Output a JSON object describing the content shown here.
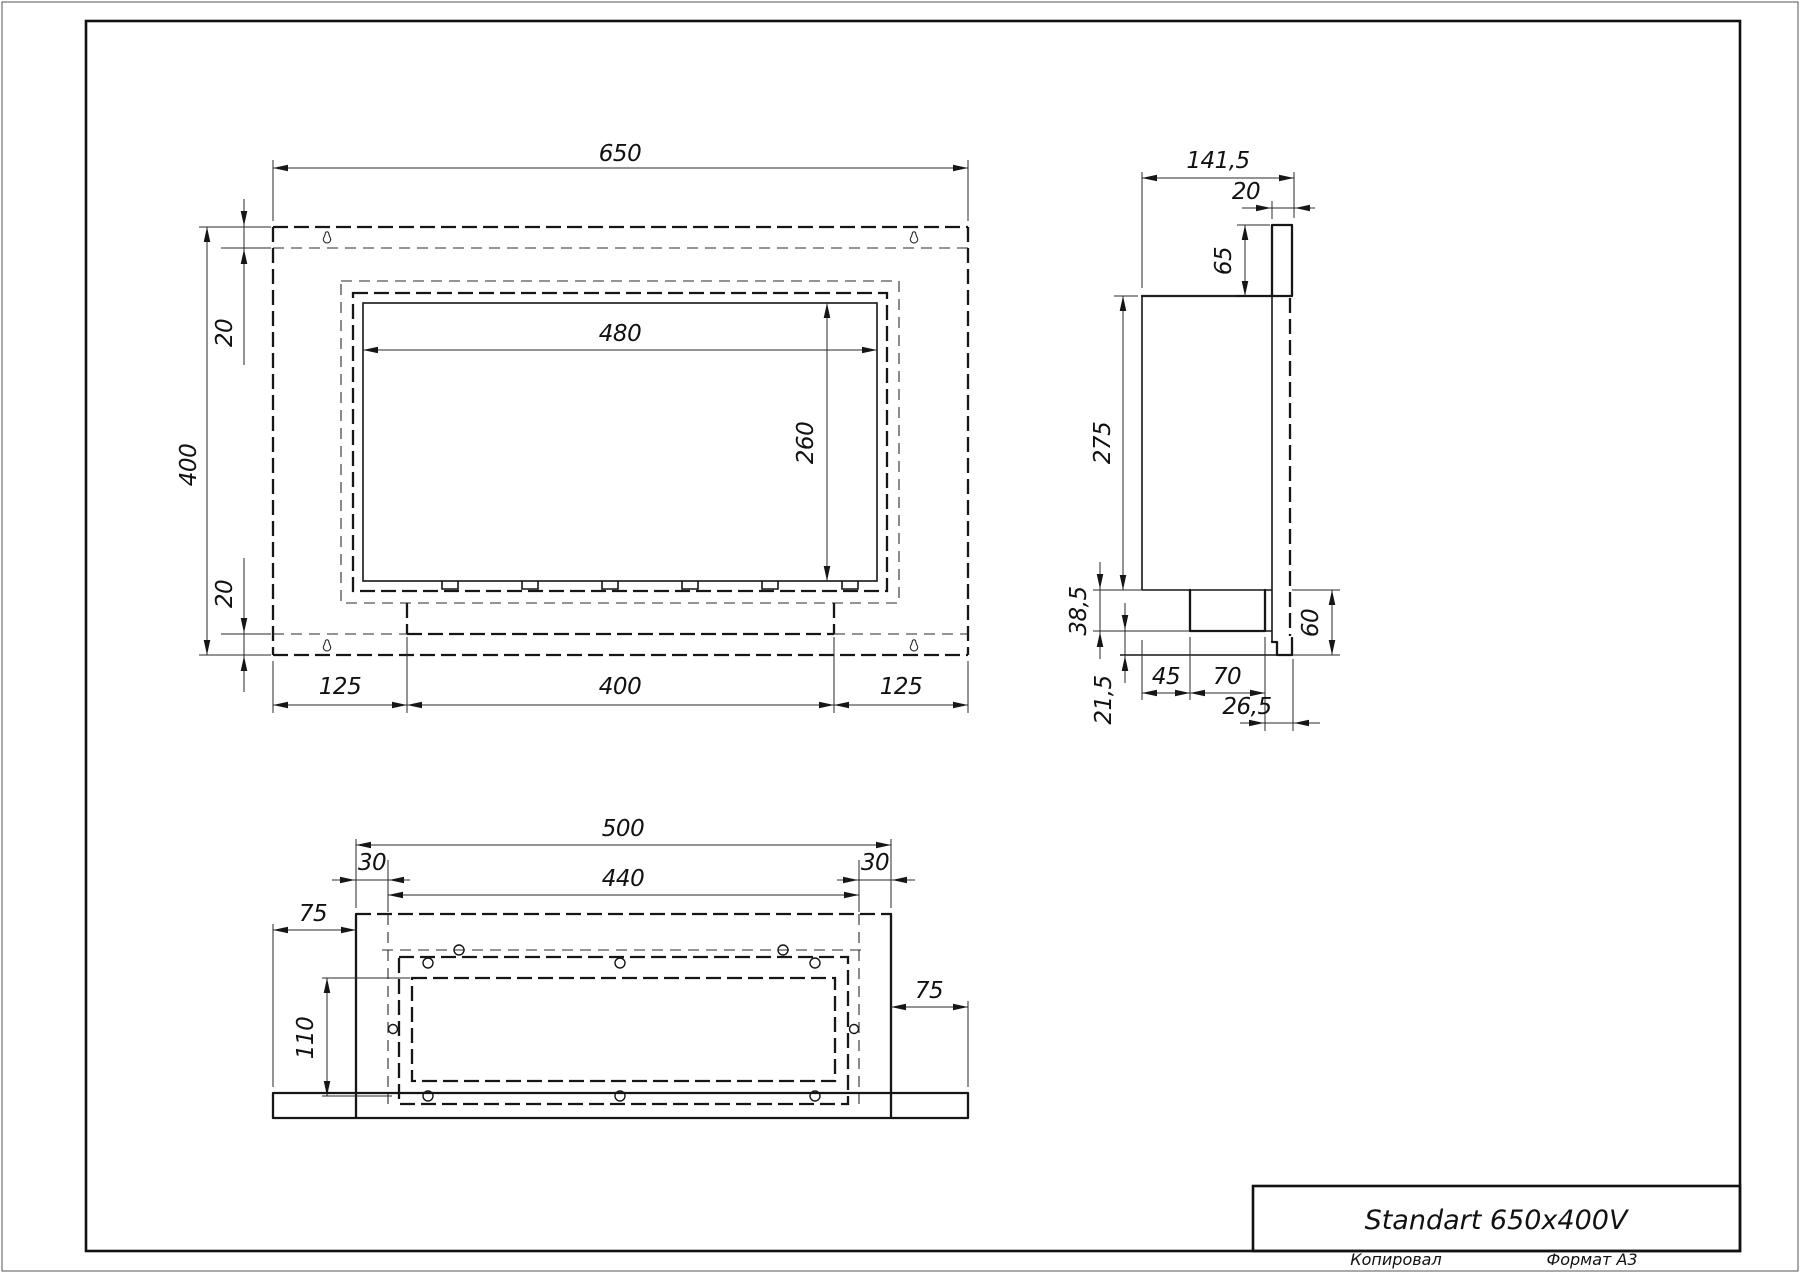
{
  "drawing": {
    "title": "Standart 650x400V",
    "footer": {
      "copied": "Копировал",
      "format": "Формат A3"
    },
    "front_view": {
      "width": "650",
      "height": "400",
      "opening_width": "480",
      "opening_height": "260",
      "top_inset": "20",
      "bottom_inset": "20",
      "bottom_left": "125",
      "bottom_center": "400",
      "bottom_right": "125"
    },
    "side_view": {
      "depth": "141,5",
      "flange_thickness": "20",
      "flange_top_offset": "65",
      "body_height": "275",
      "burner_height": "38,5",
      "bottom_lip": "21,5",
      "burner_offset": "45",
      "burner_width": "70",
      "back_offset": "26,5",
      "bottom_height": "60"
    },
    "bottom_view": {
      "bracket_width": "500",
      "inset_left": "30",
      "inset_right": "30",
      "inner_width": "440",
      "overhang_left": "75",
      "tray_depth": "110",
      "overhang_right": "75"
    }
  }
}
